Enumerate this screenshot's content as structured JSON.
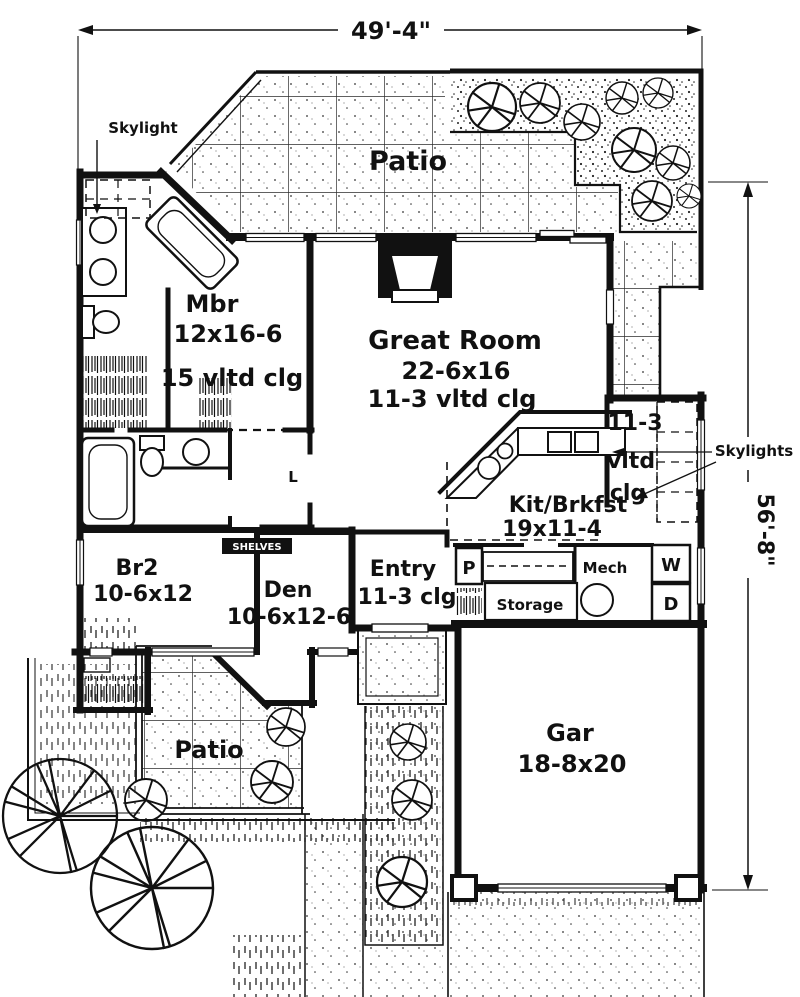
{
  "page": {
    "paper": "#ffffff",
    "ink": "#111111",
    "type": "house floor plan"
  },
  "dimensions": {
    "top": "49'-4\"",
    "right": "56'-8\""
  },
  "rooms": {
    "patio_top": {
      "name": "Patio"
    },
    "mbr": {
      "name": "Mbr",
      "size": "12x16-6",
      "ceiling": "15 vltd clg"
    },
    "great_room": {
      "name": "Great Room",
      "size": "22-6x16",
      "ceiling": "11-3 vltd clg"
    },
    "rear_hall": {
      "ceiling_line1": "11-3",
      "ceiling_line2": "vltd",
      "ceiling_line3": "clg"
    },
    "kitchen": {
      "name": "Kit/Brkfst",
      "size": "19x11-4"
    },
    "entry": {
      "name": "Entry",
      "ceiling": "11-3 clg"
    },
    "den": {
      "name": "Den",
      "size": "10-6x12-6"
    },
    "br2": {
      "name": "Br2",
      "size": "10-6x12"
    },
    "garage": {
      "name": "Gar",
      "size": "18-8x20"
    },
    "patio_bottom": {
      "name": "Patio"
    },
    "storage": {
      "name": "Storage"
    },
    "mech": {
      "name": "Mech"
    }
  },
  "labels": {
    "skylight": "Skylight",
    "skylights": "Skylights",
    "shelves": "SHELVES",
    "pantry": "P",
    "washer": "W",
    "dryer": "D",
    "linen": "L"
  }
}
